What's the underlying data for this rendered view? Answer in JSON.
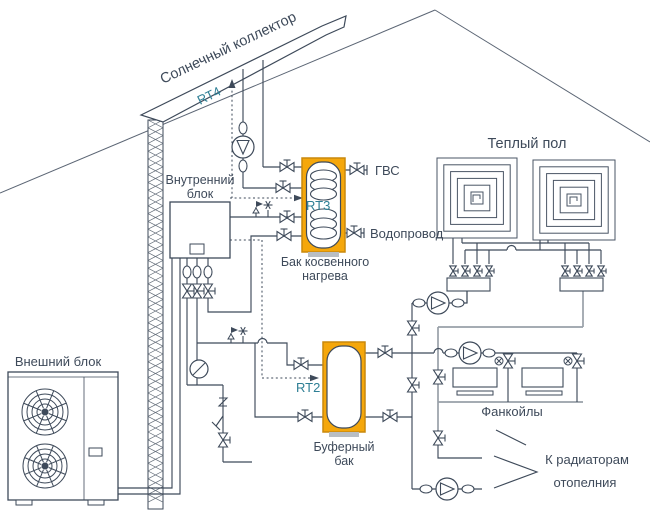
{
  "labels": {
    "solar_collector": "Солнечный коллектор",
    "rt4": "RT4",
    "rt3": "RT3",
    "rt2": "RT2",
    "indoor_unit_line1": "Внутренний",
    "indoor_unit_line2": "блок",
    "outdoor_unit": "Внешний блок",
    "dhw": "ГВС",
    "water_supply": "Водопровод",
    "indirect_tank_line1": "Бак косвенного",
    "indirect_tank_line2": "нагрева",
    "warm_floor": "Теплый пол",
    "buffer_tank_line1": "Буферный",
    "buffer_tank_line2": "бак",
    "fan_coils": "Фанкойлы",
    "radiators_line1": "К радиаторам",
    "radiators_line2": "отопелния"
  },
  "colors": {
    "tank_accent": "#F5A70B",
    "tank_accent_edge": "#C9880C",
    "sensor_text": "#2E7F95",
    "line_primary": "#3E4A5A",
    "line_secondary": "#98A0A8",
    "tank_base": "#B9BEC4"
  }
}
